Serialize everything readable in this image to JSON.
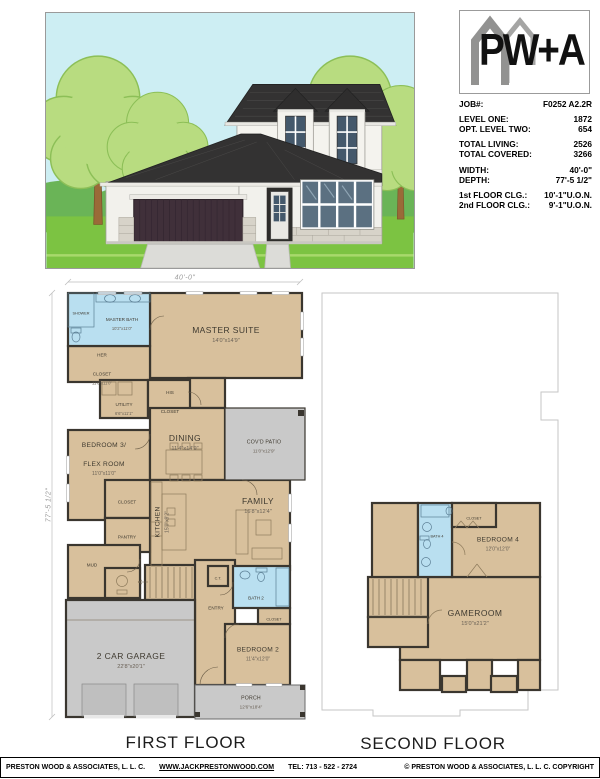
{
  "colors": {
    "room_tan": "#d8c09c",
    "bath_blue": "#b9dff0",
    "concrete_gray": "#c9c9c9",
    "wall_dark": "#3a362f",
    "sky": "#cdeef3",
    "grass": "#7cc342",
    "foliage": "#b8dc80",
    "roof": "#333232",
    "logo_gray": "#9b9b9b"
  },
  "logo": {
    "text": "PW+A"
  },
  "specs": {
    "job_label": "JOB#:",
    "job_value": "F0252 A2.2R",
    "rows": [
      {
        "label": "LEVEL ONE:",
        "value": "1872"
      },
      {
        "label": "OPT. LEVEL TWO:",
        "value": "654"
      },
      {
        "label": "TOTAL LIVING:",
        "value": "2526"
      },
      {
        "label": "TOTAL COVERED:",
        "value": "3266"
      },
      {
        "label": "WIDTH:",
        "value": "40'-0\""
      },
      {
        "label": "DEPTH:",
        "value": "77'-5 1/2\""
      },
      {
        "label": "1st FLOOR CLG.:",
        "value": "10'-1\"U.O.N."
      },
      {
        "label": "2nd FLOOR CLG.:",
        "value": "9'-1\"U.O.N."
      }
    ]
  },
  "first_floor": {
    "title": "FIRST FLOOR",
    "dim_width": "40'-0\"",
    "dim_depth": "77'-5 1/2\"",
    "rooms": {
      "shower": {
        "name": "SHOWER"
      },
      "master_bath": {
        "name": "MASTER BATH",
        "dims": "10'2\"x11'0\""
      },
      "master_suite": {
        "name": "MASTER SUITE",
        "dims": "14'0\"x14'9\""
      },
      "her_closet": {
        "name": "HER\nCLOSET",
        "dims": "11'8\"x11'0\""
      },
      "utility": {
        "name": "UTILITY",
        "dims": "6'6\"x11'1\""
      },
      "his_closet": {
        "name": "HIS\nCLOSET"
      },
      "bedroom3": {
        "name": "BEDROOM 3/\nFLEX ROOM",
        "dims": "11'0\"x11'0\""
      },
      "closet3": {
        "name": "CLOSET"
      },
      "dining": {
        "name": "DINING",
        "dims": "11'4\"x14'9\""
      },
      "covd_patio": {
        "name": "COV'D PATIO",
        "dims": "11'0\"x12'9\""
      },
      "kitchen": {
        "name": "KITCHEN",
        "dims": "15'0\"x9'2\""
      },
      "family": {
        "name": "FAMILY",
        "dims": "16'8\"x12'4\""
      },
      "pantry": {
        "name": "PANTRY"
      },
      "mud": {
        "name": "MUD"
      },
      "entry": {
        "name": "ENTRY"
      },
      "ct": {
        "name": "C.T."
      },
      "bath2": {
        "name": "BATH 2"
      },
      "closet2": {
        "name": "CLOSET"
      },
      "bedroom2": {
        "name": "BEDROOM 2",
        "dims": "11'4\"x12'0\""
      },
      "porch": {
        "name": "PORCH",
        "dims": "12'6\"x18'4\""
      },
      "garage": {
        "name": "2 CAR GARAGE",
        "dims": "22'8\"x20'1\""
      }
    }
  },
  "second_floor": {
    "title": "SECOND FLOOR",
    "rooms": {
      "bath4": {
        "name": "BATH 4"
      },
      "closet4": {
        "name": "CLOSET"
      },
      "bedroom4": {
        "name": "BEDROOM 4",
        "dims": "12'0\"x12'0\""
      },
      "gameroom": {
        "name": "GAMEROOM",
        "dims": "15'0\"x21'2\""
      }
    }
  },
  "footer": {
    "company": "PRESTON WOOD & ASSOCIATES, L. L. C.",
    "website": "WWW.JACKPRESTONWOOD.COM",
    "tel": "TEL:  713 - 522 - 2724",
    "copyright": "© PRESTON WOOD & ASSOCIATES, L. L. C.  COPYRIGHT"
  }
}
